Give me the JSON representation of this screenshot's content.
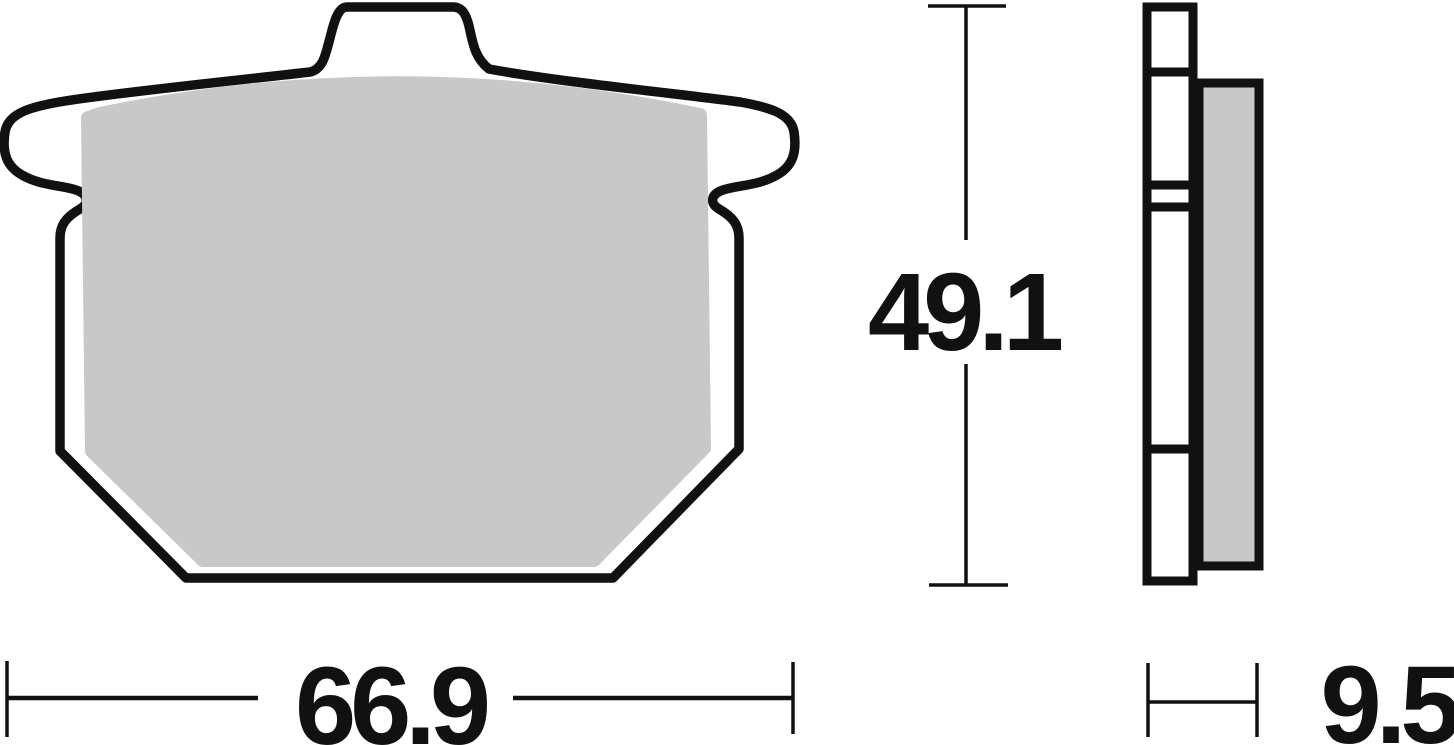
{
  "drawing": {
    "dimensions": {
      "height": "49.1",
      "width": "66.9",
      "thickness": "9.5"
    },
    "colors": {
      "line": "#111111",
      "friction": "#c8c8c8",
      "plate": "#ffffff",
      "background": "#ffffff"
    }
  }
}
